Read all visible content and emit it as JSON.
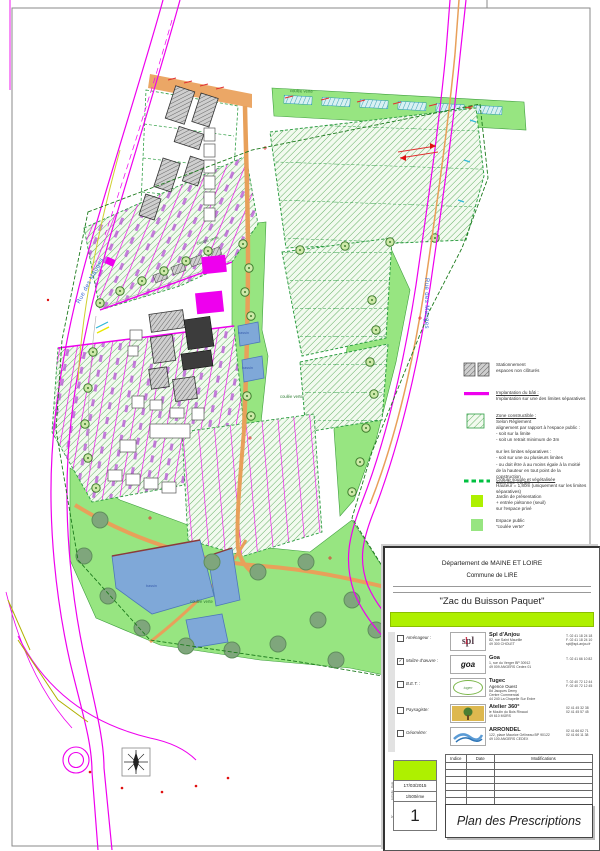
{
  "sheet": {
    "background": "#ffffff",
    "frame_color": "#8a8a8a"
  },
  "map": {
    "labels": {
      "rue_left": "Rue des Mauges",
      "rue_right": "Rue des Mauges",
      "coulee_north": "coulée verte",
      "coulee_center": "coulée verte",
      "coulee_east": "coulée verte",
      "coulee_south": "coulée verte",
      "bassin_1": "bassin",
      "bassin_2": "bassin",
      "bassin_south": "bassin"
    },
    "colors": {
      "road_magenta": "#ee00ee",
      "path_orange": "#e8a05a",
      "public_green": "#97e581",
      "pond_blue": "#7fa8d8",
      "lot_hatch_green": "#55a855",
      "label_blue": "#3a6bd6",
      "lime": "#aef000"
    }
  },
  "legend": {
    "items": [
      {
        "title": "",
        "body": "Stationnement\nespaces non clôturés"
      },
      {
        "title": "Implantation du bâti :",
        "body": "Implantation sur une des limites séparatives"
      },
      {
        "title": "Zone constructible :",
        "body": "Selon Règlement\nalignement par rapport à l'espace public :\n-    soit sur la limite\n-    soit un retrait minimum de 3m\n\nsur les limites séparatives :\n-    soit sur une ou plusieurs limites\n-    ou doit être à au moins égale à la moitié\n      de la hauteur en tout point de la\n      construction\n      sans être < à 3m"
      },
      {
        "title": "Clôture souple et végétalisée",
        "body": "Hauteur = 1,80m (uniquement sur les limites\nséparatives)"
      },
      {
        "title": "",
        "body": "Jardin de présentation\n+ entrée piétonne (seuil)\nsur l'espace privé"
      },
      {
        "title": "",
        "body": "Espace public\n\"coulée verte\""
      }
    ]
  },
  "title_block": {
    "department": "Département de MAINE ET LOIRE",
    "commune": "Commune de LIRE",
    "project": "\"Zac du Buisson Paquet\"",
    "companies": [
      {
        "role": "Aménageur :",
        "check": "",
        "logo_text": "spl",
        "logo_mark": "1",
        "name": "Spl d'Anjou",
        "sub": "",
        "address": "82, rue Saint Maurille\n49 300 CHOLET",
        "contact": "T.  02 41 18 24 18\nF.  02 41 18 24 10\nspl@spl-anjou.fr"
      },
      {
        "role": "Maître d'œuvre :",
        "check": "✓",
        "logo_text": "goa",
        "logo_mark": "",
        "name": "Goa",
        "sub": "",
        "address": "1, rue du Verger BP 30912\n49 009 ANGERS  Cedex 01",
        "contact": "T.  02 41 66 10 82"
      },
      {
        "role": "B.E.T. :",
        "check": "",
        "logo_text": "tugec",
        "logo_mark": "",
        "name": "Tugec",
        "sub": "Agence Ouest",
        "address": "8d Jacques Demy\nCentre Commercial\n44 240 La Chapelle Sur Erdre",
        "contact": "T.  02 40 72 12 44\nF.  02 40 72 12 45"
      },
      {
        "role": "Paysagiste:",
        "check": "",
        "logo_text": "",
        "logo_mark": "",
        "name": "Atelier 360°",
        "sub": "",
        "address": "le Moulin du Bois Rinaud\n49 610 MÛRS",
        "contact": "02 41 45 32 38\n02 41 45 57 45"
      },
      {
        "role": "Géomètre:",
        "check": "",
        "logo_text": "",
        "logo_mark": "",
        "name": "ARRONDEL",
        "sub": "",
        "address": "122, place Maurice Gélineau BP 90122\n49 100 ANGERS CEDEX",
        "contact": "02 41 66 62 71\n02 41 66 11 38"
      }
    ],
    "revisions": {
      "headers": [
        "Indice",
        "Date",
        "Modifications"
      ]
    },
    "meta": {
      "date_label": "Date",
      "date": "17/03/2015",
      "scale_label": "Echelle",
      "scale": "1/500ème",
      "number_label": "N°",
      "number": "1"
    },
    "plan_title": "Plan des Prescriptions"
  }
}
